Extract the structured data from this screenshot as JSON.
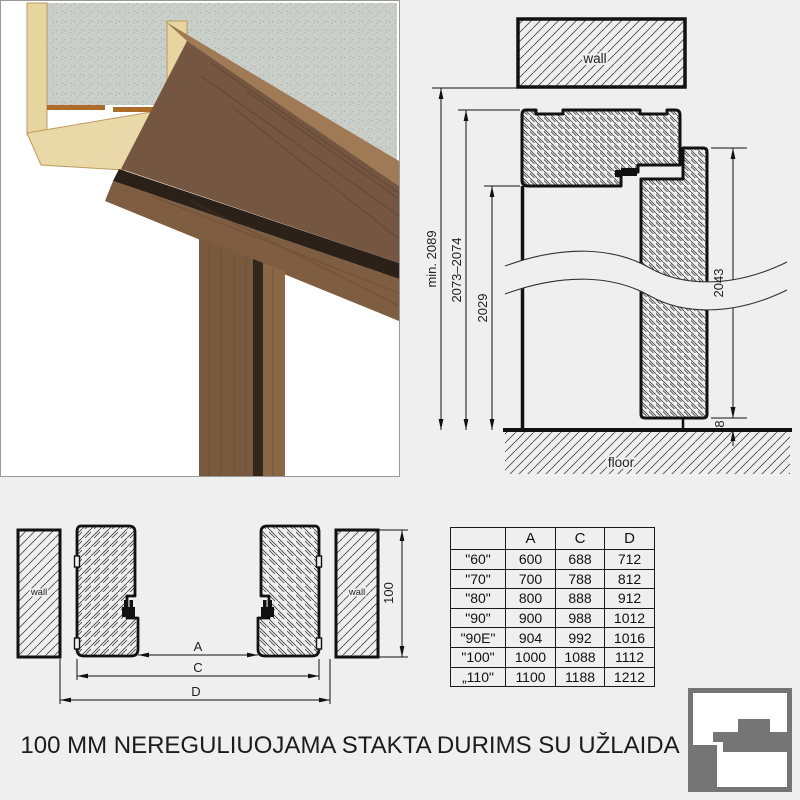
{
  "page": {
    "background": "#efefef",
    "title": "100 MM NEREGULIUOJAMA STAKTA DURIMS SU UŽLAIDA"
  },
  "section_drawing": {
    "wall_label": "wall",
    "floor_label": "floor",
    "dim_total": "min. 2089",
    "dim_frame": "2073–2074",
    "dim_opening": "2029",
    "dim_leaf": "2043",
    "dim_floor_gap": "8"
  },
  "plan_drawing": {
    "wall_left_label": "wall",
    "wall_right_label": "wall",
    "dim_a": "A",
    "dim_c": "C",
    "dim_d": "D",
    "dim_depth": "100"
  },
  "spec_table": {
    "headers": [
      "",
      "A",
      "C",
      "D"
    ],
    "rows": [
      [
        "\"60\"",
        "600",
        "688",
        "712"
      ],
      [
        "\"70\"",
        "700",
        "788",
        "812"
      ],
      [
        "\"80\"",
        "800",
        "888",
        "912"
      ],
      [
        "\"90\"",
        "900",
        "988",
        "1012"
      ],
      [
        "\"90E\"",
        "904",
        "992",
        "1016"
      ],
      [
        "\"100\"",
        "1000",
        "1088",
        "1112"
      ],
      [
        "„110\"",
        "1100",
        "1188",
        "1212"
      ]
    ]
  },
  "logo": {
    "color": "#757575"
  }
}
